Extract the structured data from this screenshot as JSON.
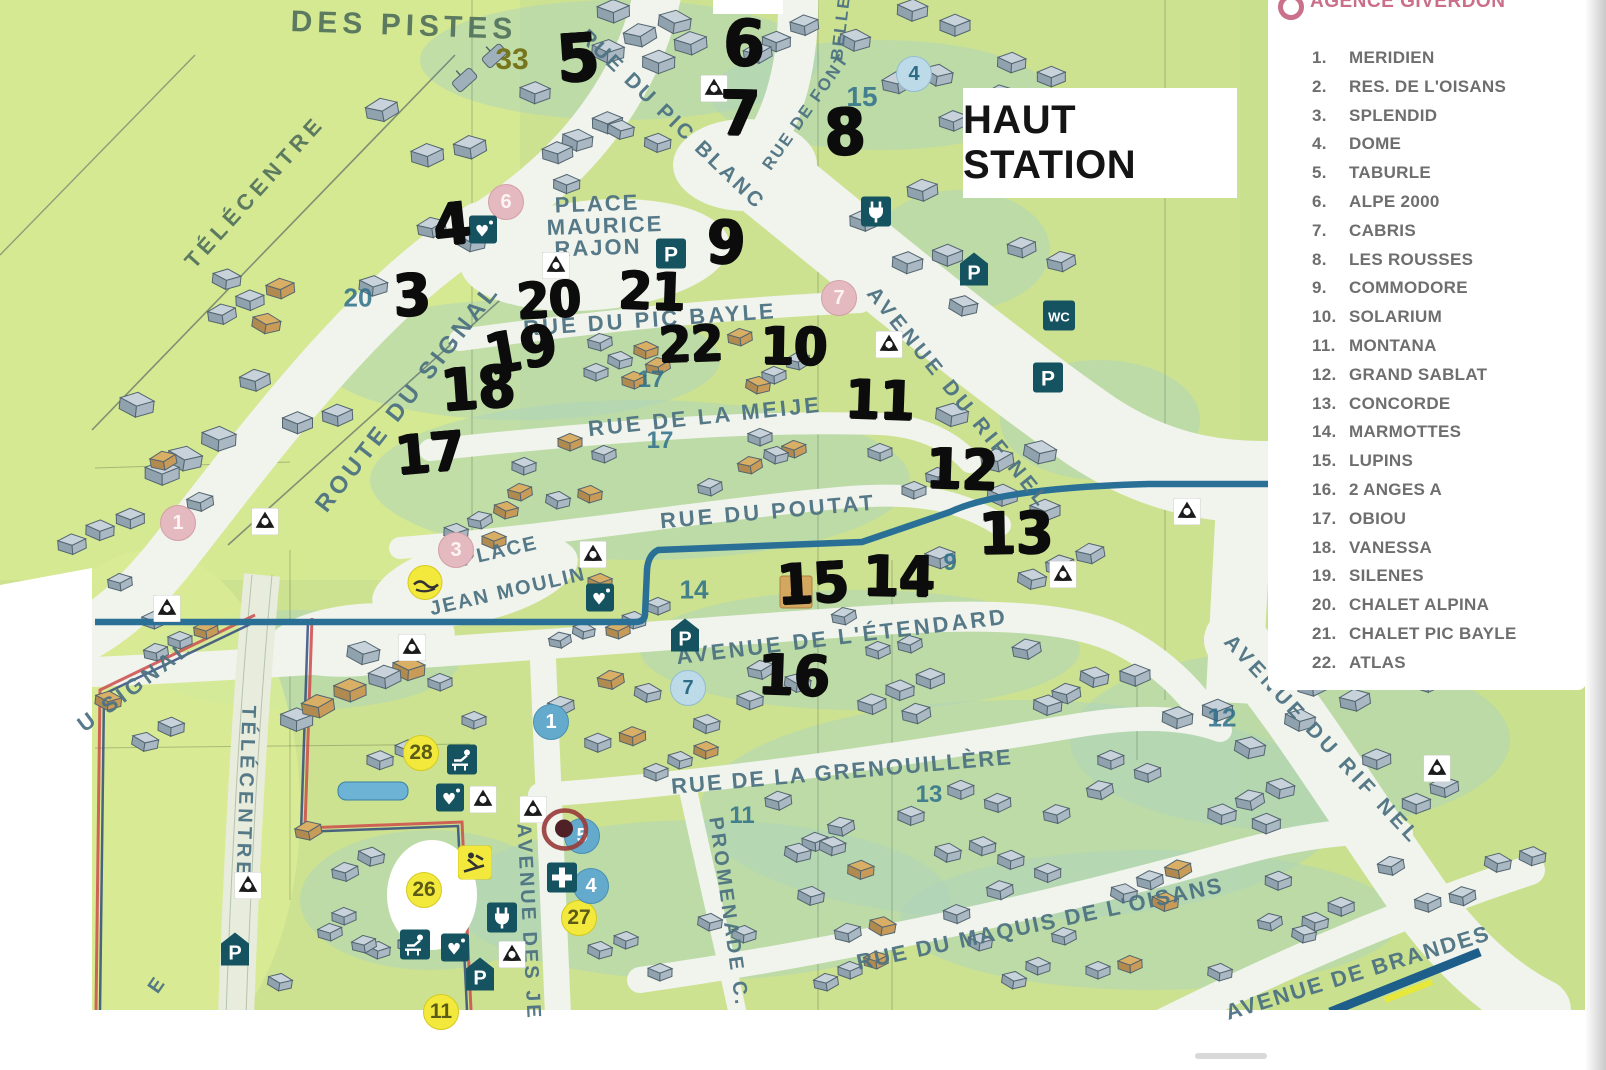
{
  "header": {
    "agency": "AGENCE GIVERDON",
    "title": "HAUT STATION"
  },
  "palette": {
    "map_green": "#cde290",
    "road_white": "#f1f3ed",
    "stream_blue": "#2a6f96",
    "handwriting": "#0c0c0c",
    "street_text": "#4e7383",
    "icon_teal": "#14535f",
    "badge_pink": "#e4b9bf",
    "badge_blue": "#bcdae8",
    "badge_yellow": "#f2e93c",
    "agency_pink": "#c4607e"
  },
  "legend": {
    "items": [
      {
        "num": "1.",
        "name": "MERIDIEN"
      },
      {
        "num": "2.",
        "name": "RES. DE L'OISANS"
      },
      {
        "num": "3.",
        "name": "SPLENDID"
      },
      {
        "num": "4.",
        "name": "DOME"
      },
      {
        "num": "5.",
        "name": "TABURLE"
      },
      {
        "num": "6.",
        "name": "ALPE 2000"
      },
      {
        "num": "7.",
        "name": "CABRIS"
      },
      {
        "num": "8.",
        "name": "LES ROUSSES"
      },
      {
        "num": "9.",
        "name": "COMMODORE"
      },
      {
        "num": "10.",
        "name": "SOLARIUM"
      },
      {
        "num": "11.",
        "name": "MONTANA"
      },
      {
        "num": "12.",
        "name": "GRAND SABLAT"
      },
      {
        "num": "13.",
        "name": "CONCORDE"
      },
      {
        "num": "14.",
        "name": "MARMOTTES"
      },
      {
        "num": "15.",
        "name": "LUPINS"
      },
      {
        "num": "16.",
        "name": "2 ANGES A"
      },
      {
        "num": "17.",
        "name": "OBIOU"
      },
      {
        "num": "18.",
        "name": "VANESSA"
      },
      {
        "num": "19.",
        "name": "SILENES"
      },
      {
        "num": "20.",
        "name": "CHALET ALPINA"
      },
      {
        "num": "21.",
        "name": "CHALET PIC BAYLE"
      },
      {
        "num": "22.",
        "name": "ATLAS"
      }
    ]
  },
  "map": {
    "streets": [
      {
        "t": "DES PISTES",
        "x": 404,
        "y": 26,
        "r": 2,
        "s": 30,
        "sp": 5,
        "c": "#55755e"
      },
      {
        "t": "TÉLÉCENTRE",
        "x": 255,
        "y": 192,
        "r": -48,
        "s": 22,
        "sp": 5,
        "c": "#55755e"
      },
      {
        "t": "RUE DU PIC BLANC",
        "x": 672,
        "y": 120,
        "r": 44,
        "s": 21,
        "sp": 3
      },
      {
        "t": "RUE DE FONT",
        "x": 806,
        "y": 112,
        "r": -55,
        "s": 17,
        "sp": 2
      },
      {
        "t": "BELLE",
        "x": 841,
        "y": 28,
        "r": -83,
        "s": 17,
        "sp": 2
      },
      {
        "t": "PLACE",
        "x": 597,
        "y": 204,
        "r": -2,
        "s": 22,
        "sp": 2
      },
      {
        "t": "MAURICE",
        "x": 605,
        "y": 226,
        "r": -2,
        "s": 22,
        "sp": 2
      },
      {
        "t": "RAJON",
        "x": 598,
        "y": 248,
        "r": -2,
        "s": 22,
        "sp": 2
      },
      {
        "t": "ROUTE DU SIGNAL",
        "x": 408,
        "y": 398,
        "r": -52,
        "s": 24,
        "sp": 4
      },
      {
        "t": "RUE DU PIC BAYLE",
        "x": 650,
        "y": 320,
        "r": -4,
        "s": 22,
        "sp": 3
      },
      {
        "t": "RUE DE LA MEIJE",
        "x": 705,
        "y": 417,
        "r": -6,
        "s": 22,
        "sp": 3
      },
      {
        "t": "RUE DU POUTAT",
        "x": 768,
        "y": 512,
        "r": -5,
        "s": 22,
        "sp": 3
      },
      {
        "t": "AVENUE DU RIF NEL",
        "x": 958,
        "y": 398,
        "r": 51,
        "s": 21,
        "sp": 4
      },
      {
        "t": "AVENUE DE L'ÉTENDARD",
        "x": 842,
        "y": 637,
        "r": -7,
        "s": 22,
        "sp": 3
      },
      {
        "t": "RUE DE LA GRENOUILLÈRE",
        "x": 842,
        "y": 772,
        "r": -5,
        "s": 22,
        "sp": 2
      },
      {
        "t": "AVENUE DU RIF NEL",
        "x": 1322,
        "y": 740,
        "r": 47,
        "s": 21,
        "sp": 4
      },
      {
        "t": "RUE DU MAQUIS DE L'OISANS",
        "x": 1040,
        "y": 924,
        "r": -12,
        "s": 22,
        "sp": 2
      },
      {
        "t": "AVENUE DE BRANDES",
        "x": 1358,
        "y": 973,
        "r": -17,
        "s": 22,
        "sp": 2
      },
      {
        "t": "PROMENADE C.",
        "x": 728,
        "y": 912,
        "r": 82,
        "s": 20,
        "sp": 3
      },
      {
        "t": "AVENUE DES JE",
        "x": 528,
        "y": 922,
        "r": 87,
        "s": 20,
        "sp": 3
      },
      {
        "t": "U SIGNAL",
        "x": 135,
        "y": 686,
        "r": -37,
        "s": 22,
        "sp": 4
      },
      {
        "t": "TÉLÉCENTRE",
        "x": 245,
        "y": 792,
        "r": 92,
        "s": 20,
        "sp": 4
      },
      {
        "t": "PLACE",
        "x": 500,
        "y": 552,
        "r": -13,
        "s": 20,
        "sp": 2
      },
      {
        "t": "JEAN MOULIN",
        "x": 508,
        "y": 592,
        "r": -13,
        "s": 20,
        "sp": 2
      },
      {
        "t": "E",
        "x": 157,
        "y": 986,
        "r": -55,
        "s": 20,
        "sp": 0
      }
    ],
    "handwritten": [
      {
        "t": "5",
        "x": 578,
        "y": 58,
        "s": 66,
        "r": -4
      },
      {
        "t": "6",
        "x": 744,
        "y": 44,
        "s": 64,
        "r": 2
      },
      {
        "t": "7",
        "x": 740,
        "y": 113,
        "s": 62,
        "r": 1
      },
      {
        "t": "8",
        "x": 845,
        "y": 133,
        "s": 64,
        "r": -2
      },
      {
        "t": "4",
        "x": 452,
        "y": 224,
        "s": 58,
        "r": -6
      },
      {
        "t": "9",
        "x": 726,
        "y": 243,
        "s": 60,
        "r": 3
      },
      {
        "t": "3",
        "x": 412,
        "y": 295,
        "s": 58,
        "r": -3
      },
      {
        "t": "20",
        "x": 549,
        "y": 300,
        "s": 50,
        "r": -3
      },
      {
        "t": "21",
        "x": 652,
        "y": 292,
        "s": 52,
        "r": 2
      },
      {
        "t": "22",
        "x": 691,
        "y": 344,
        "s": 50,
        "r": -2
      },
      {
        "t": "10",
        "x": 794,
        "y": 347,
        "s": 52,
        "r": 1
      },
      {
        "t": "19",
        "x": 521,
        "y": 350,
        "s": 56,
        "r": -10
      },
      {
        "t": "18",
        "x": 478,
        "y": 388,
        "s": 58,
        "r": -4
      },
      {
        "t": "11",
        "x": 880,
        "y": 400,
        "s": 54,
        "r": 2
      },
      {
        "t": "17",
        "x": 430,
        "y": 453,
        "s": 54,
        "r": -5
      },
      {
        "t": "12",
        "x": 962,
        "y": 470,
        "s": 56,
        "r": 2
      },
      {
        "t": "13",
        "x": 1016,
        "y": 533,
        "s": 58,
        "r": -1
      },
      {
        "t": "15",
        "x": 813,
        "y": 584,
        "s": 56,
        "r": -3
      },
      {
        "t": "14",
        "x": 899,
        "y": 577,
        "s": 56,
        "r": 1
      },
      {
        "t": "16",
        "x": 794,
        "y": 676,
        "s": 56,
        "r": 2
      }
    ],
    "printed_markers": [
      {
        "t": "33",
        "x": 512,
        "y": 60,
        "v": "olive",
        "s": 30
      },
      {
        "t": "15",
        "x": 862,
        "y": 97,
        "v": "teal",
        "s": 28
      },
      {
        "t": "4",
        "x": 914,
        "y": 74,
        "v": "circle-blue"
      },
      {
        "t": "6",
        "x": 506,
        "y": 202,
        "v": "circle-pink"
      },
      {
        "t": "20",
        "x": 358,
        "y": 298,
        "v": "teal",
        "s": 26
      },
      {
        "t": "7",
        "x": 839,
        "y": 298,
        "v": "circle-pink"
      },
      {
        "t": "17",
        "x": 651,
        "y": 380,
        "v": "teal",
        "s": 24
      },
      {
        "t": "17",
        "x": 660,
        "y": 441,
        "v": "teal",
        "s": 24
      },
      {
        "t": "14",
        "x": 694,
        "y": 590,
        "v": "teal",
        "s": 26
      },
      {
        "t": "9",
        "x": 950,
        "y": 563,
        "v": "teal",
        "s": 24
      },
      {
        "t": "4",
        "x": 796,
        "y": 592,
        "v": "square-tan"
      },
      {
        "t": "7",
        "x": 688,
        "y": 688,
        "v": "circle-blue"
      },
      {
        "t": "1",
        "x": 551,
        "y": 722,
        "v": "circle-blue-dark"
      },
      {
        "t": "12",
        "x": 1222,
        "y": 718,
        "v": "teal",
        "s": 26
      },
      {
        "t": "11",
        "x": 742,
        "y": 816,
        "v": "teal",
        "s": 24
      },
      {
        "t": "13",
        "x": 929,
        "y": 795,
        "v": "teal",
        "s": 24
      },
      {
        "t": "1",
        "x": 178,
        "y": 523,
        "v": "circle-pink"
      },
      {
        "t": "3",
        "x": 456,
        "y": 550,
        "v": "circle-pink"
      },
      {
        "t": "28",
        "x": 421,
        "y": 753,
        "v": "circle-yellow"
      },
      {
        "t": "26",
        "x": 424,
        "y": 890,
        "v": "circle-yellow"
      },
      {
        "t": "27",
        "x": 579,
        "y": 918,
        "v": "circle-yellow"
      },
      {
        "t": "11",
        "x": 441,
        "y": 1012,
        "v": "circle-yellow"
      },
      {
        "t": "4",
        "x": 591,
        "y": 886,
        "v": "circle-blue-dark"
      },
      {
        "t": "5",
        "x": 582,
        "y": 836,
        "v": "circle-blue-dark"
      }
    ],
    "icons": [
      {
        "k": "recycle",
        "x": 714,
        "y": 91
      },
      {
        "k": "recycle",
        "x": 556,
        "y": 268
      },
      {
        "k": "recycle",
        "x": 889,
        "y": 347
      },
      {
        "k": "recycle",
        "x": 265,
        "y": 524
      },
      {
        "k": "recycle",
        "x": 167,
        "y": 611
      },
      {
        "k": "recycle",
        "x": 593,
        "y": 557
      },
      {
        "k": "recycle",
        "x": 412,
        "y": 650
      },
      {
        "k": "recycle",
        "x": 1187,
        "y": 514
      },
      {
        "k": "recycle",
        "x": 1063,
        "y": 577
      },
      {
        "k": "recycle",
        "x": 483,
        "y": 802
      },
      {
        "k": "recycle",
        "x": 533,
        "y": 812
      },
      {
        "k": "recycle",
        "x": 512,
        "y": 957
      },
      {
        "k": "recycle",
        "x": 248,
        "y": 888
      },
      {
        "k": "recycle",
        "x": 1437,
        "y": 771
      },
      {
        "k": "parking",
        "label": "P",
        "x": 671,
        "y": 256
      },
      {
        "k": "parking-shelter",
        "label": "P",
        "x": 974,
        "y": 272
      },
      {
        "k": "wc",
        "label": "WC",
        "x": 1059,
        "y": 318
      },
      {
        "k": "parking",
        "label": "P",
        "x": 1048,
        "y": 380
      },
      {
        "k": "plug",
        "x": 876,
        "y": 214
      },
      {
        "k": "parking-shelter",
        "label": "P",
        "x": 685,
        "y": 638
      },
      {
        "k": "heart",
        "x": 483,
        "y": 232
      },
      {
        "k": "heart",
        "x": 600,
        "y": 600
      },
      {
        "k": "heart",
        "x": 450,
        "y": 800
      },
      {
        "k": "heart",
        "x": 455,
        "y": 950
      },
      {
        "k": "nursery",
        "x": 462,
        "y": 762
      },
      {
        "k": "nursery",
        "x": 415,
        "y": 947
      },
      {
        "k": "plug",
        "x": 502,
        "y": 920
      },
      {
        "k": "cross",
        "x": 562,
        "y": 880
      },
      {
        "k": "ski-yellow",
        "x": 475,
        "y": 865
      },
      {
        "k": "sledge-yellow",
        "x": 425,
        "y": 585
      },
      {
        "k": "parking-shelter",
        "label": "P",
        "x": 480,
        "y": 977
      },
      {
        "k": "parking-shelter",
        "label": "P",
        "x": 235,
        "y": 952
      },
      {
        "k": "target",
        "x": 566,
        "y": 832
      }
    ]
  }
}
